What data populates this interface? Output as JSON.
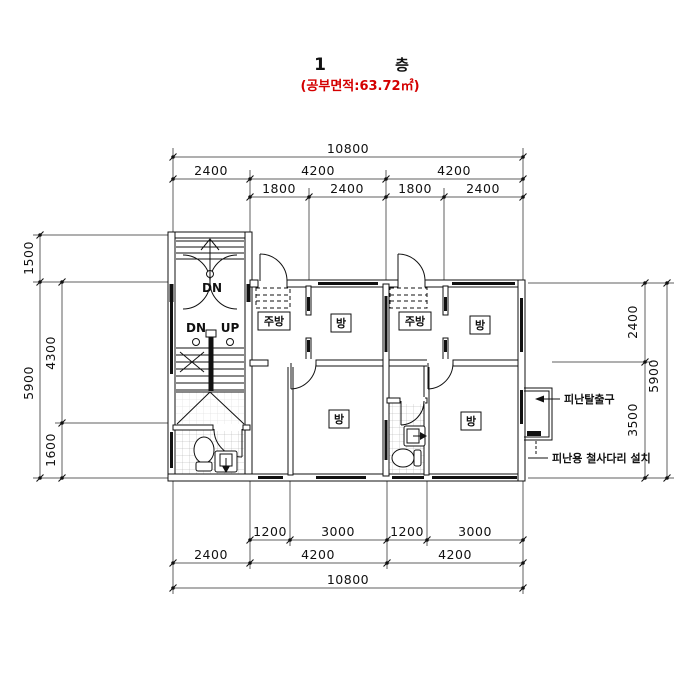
{
  "header": {
    "floor_number": "1",
    "floor_label": "층",
    "area_note": "(공부면적:63.72㎡)"
  },
  "dimensions": {
    "top": {
      "total": "10800",
      "row2": [
        "2400",
        "4200",
        "4200"
      ],
      "row3": [
        "1800",
        "2400",
        "1800",
        "2400"
      ]
    },
    "bottom": {
      "row1": [
        "1200",
        "3000",
        "1200",
        "3000"
      ],
      "row2": [
        "2400",
        "4200",
        "4200"
      ],
      "total": "10800"
    },
    "left": {
      "outer": [
        "1500",
        "5900"
      ],
      "inner": [
        "4300",
        "1600"
      ]
    },
    "right": {
      "inner": [
        "2400",
        "3500"
      ],
      "outer": "5900"
    }
  },
  "rooms": {
    "kitchen1": "주방",
    "room1": "방",
    "kitchen2": "주방",
    "room2": "방",
    "room3": "방",
    "room4": "방"
  },
  "stairs": {
    "entry_dn": "DN",
    "dn": "DN",
    "up": "UP"
  },
  "annotations": {
    "exit": "피난탈출구",
    "ladder": "피난용 철사다리 설치"
  },
  "colors": {
    "accent_red": "#d40000",
    "line": "#111111"
  }
}
